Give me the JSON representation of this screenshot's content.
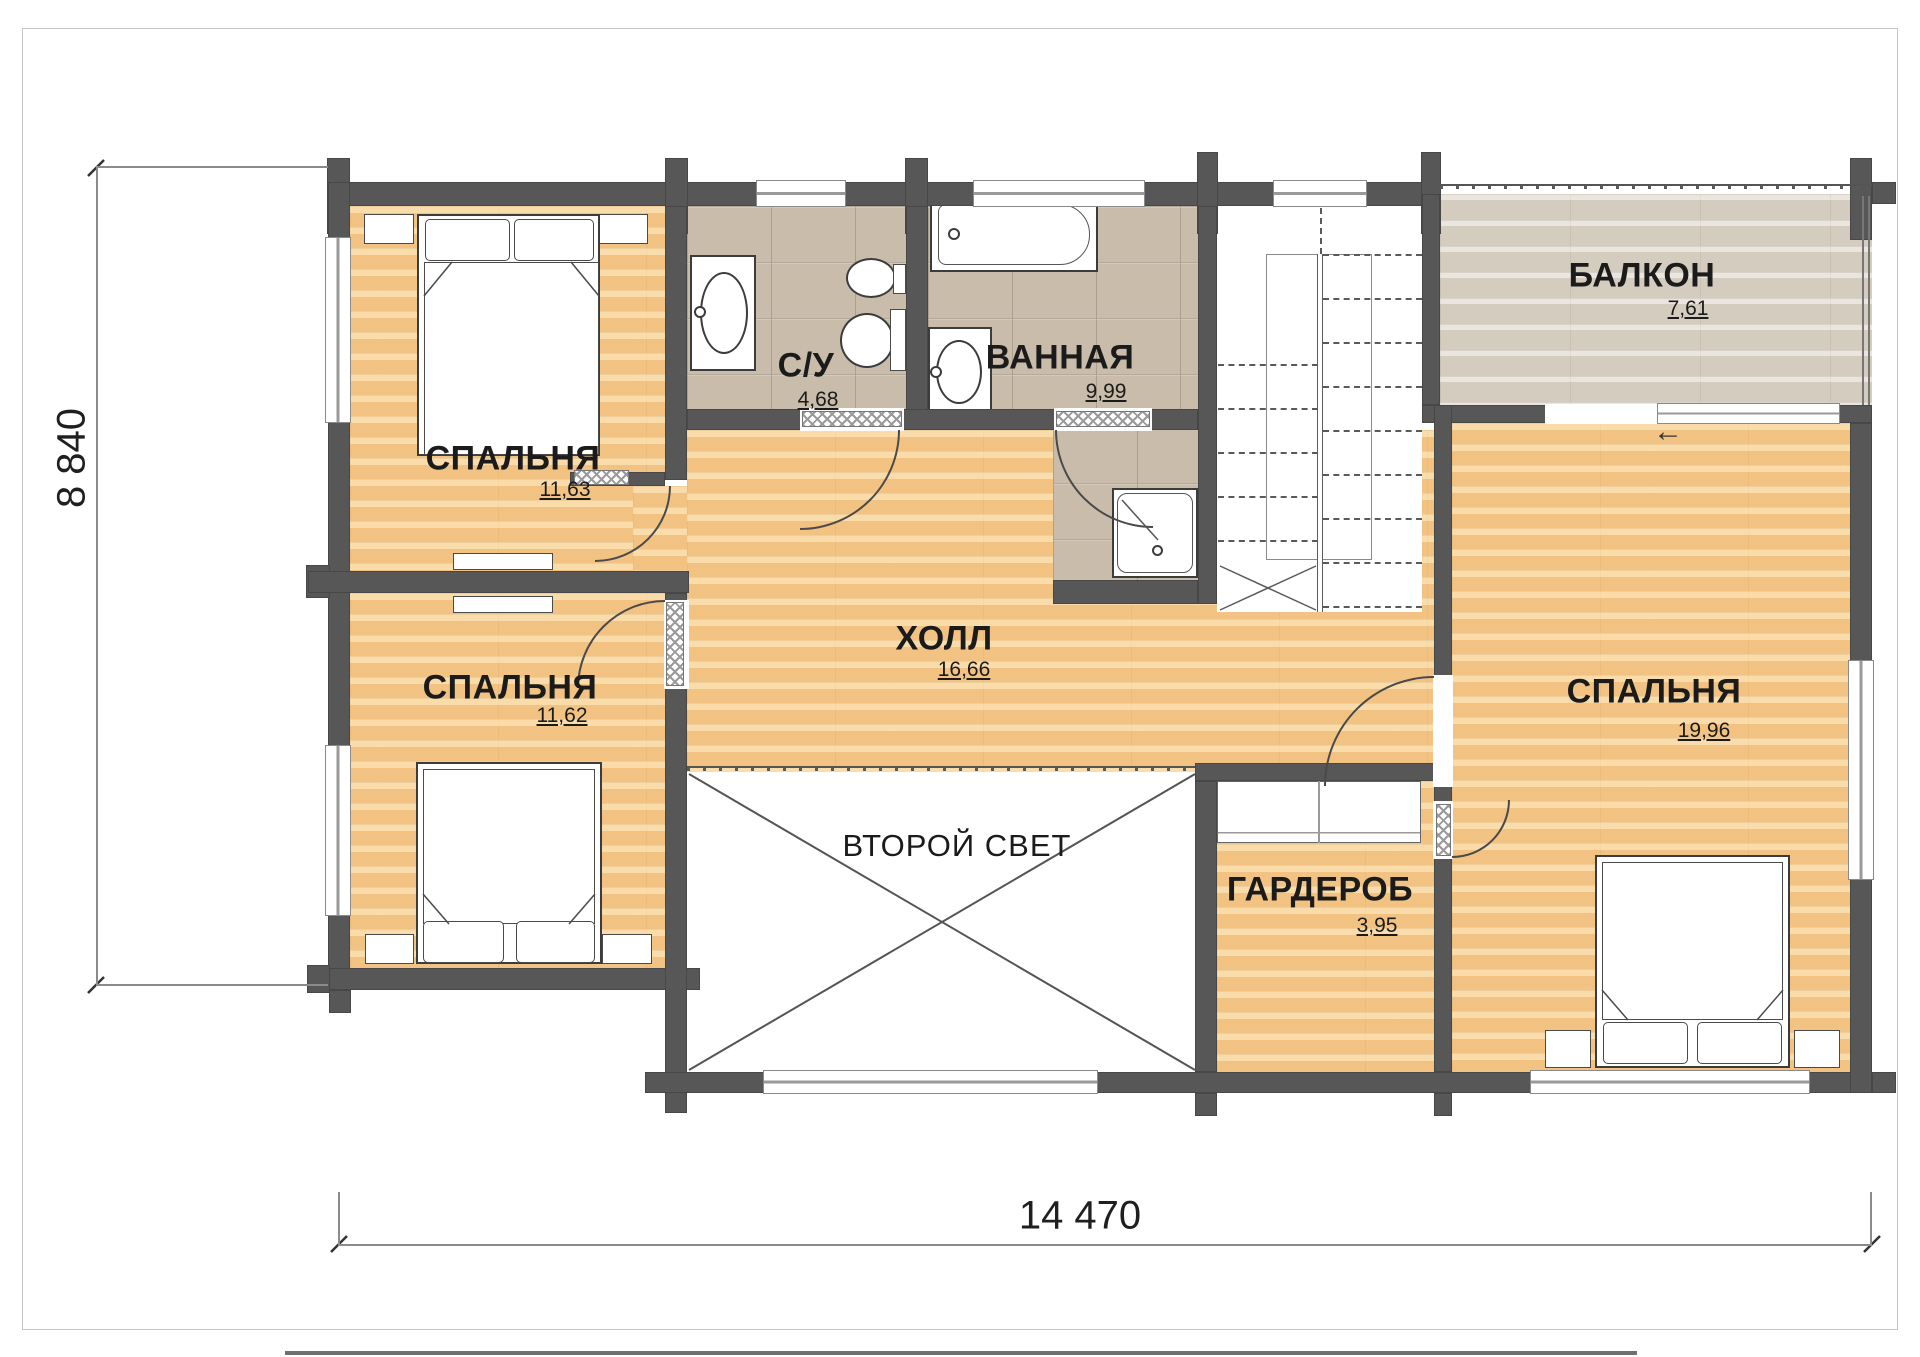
{
  "title": "План второго этажа",
  "rooms": [
    {
      "name": "СПАЛЬНЯ",
      "area": "11,63"
    },
    {
      "name": "СПАЛЬНЯ",
      "area": "11,62"
    },
    {
      "name": "С/У",
      "area": "4,68"
    },
    {
      "name": "ВАННАЯ",
      "area": "9,99"
    },
    {
      "name": "ХОЛЛ",
      "area": "16,66"
    },
    {
      "name": "БАЛКОН",
      "area": "7,61"
    },
    {
      "name": "СПАЛЬНЯ",
      "area": "19,96"
    },
    {
      "name": "ВТОРОЙ СВЕТ",
      "area": ""
    },
    {
      "name": "ГАРДЕРОБ",
      "area": "3,95"
    }
  ],
  "dimensions": {
    "bottom": "14 470",
    "left": "8 840"
  },
  "icons": {
    "balcony_entry_arrow": "←"
  },
  "colors": {
    "wall": "#575757",
    "wood_floor": "#f5c98e",
    "tile_floor": "#c9bcaa",
    "balcony_floor": "#ded7cc"
  }
}
